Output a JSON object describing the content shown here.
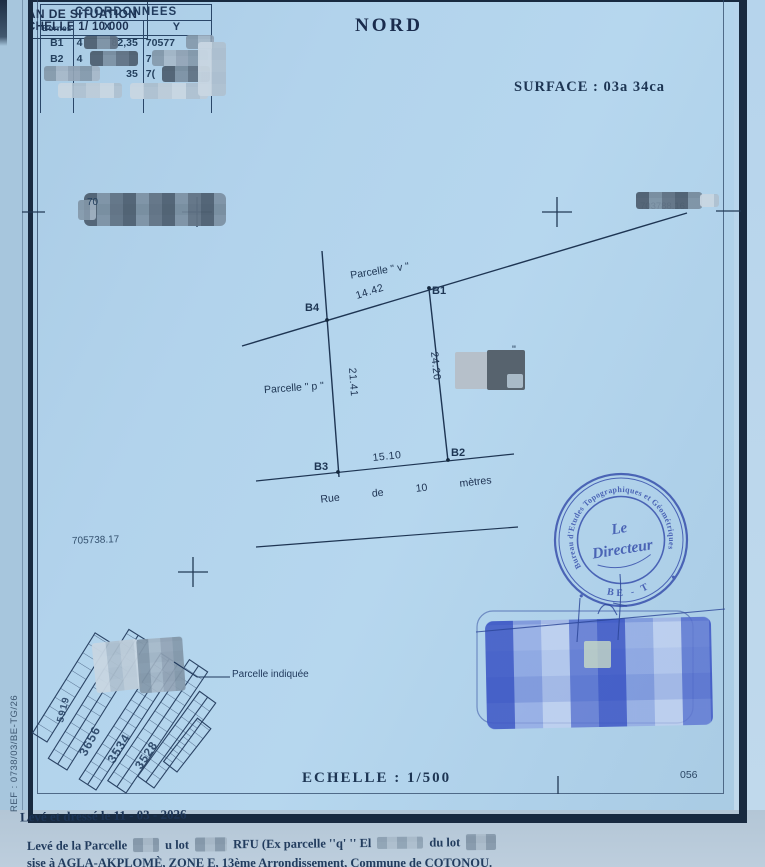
{
  "page": {
    "nord": "NORD",
    "surface": "SURFACE : 03a 34ca",
    "echelle": "ECHELLE : 1/500",
    "sheet_no": "056",
    "ref": "REF : 0738/03/BE-TG/26"
  },
  "coord_table": {
    "title": "COORDONNEES",
    "cols": {
      "bornes": "Bornes",
      "x": "X",
      "y": "Y"
    },
    "rows": [
      {
        "borne": "B1",
        "x_a": "4",
        "x_b": "82,35",
        "y_a": "70577"
      },
      {
        "borne": "B2",
        "x_a": "4",
        "x_b": "",
        "y_a": "7"
      },
      {
        "borne": "",
        "x_a": "",
        "x_b": "35",
        "y_a": "7("
      },
      {
        "borne": "",
        "x_a": "",
        "x_b": "",
        "y_a": ""
      }
    ]
  },
  "grid_refs": {
    "left": "705738.17",
    "right": "703788.16",
    "top_left": "70"
  },
  "parcel": {
    "label_v": "Parcelle \" v \"",
    "label_p": "Parcelle \" p \"",
    "b1": "B1",
    "b2": "B2",
    "b3": "B3",
    "b4": "B4",
    "dim_top": "14.42",
    "dim_right": "24.20",
    "dim_left": "21.41",
    "dim_bottom": "15.10",
    "street_w1": "Rue",
    "street_w2": "de",
    "street_w3": "10",
    "street_w4": "mètres",
    "stray_quote": "\""
  },
  "situation": {
    "title_line1": "PLAN DE SITUATION",
    "title_line2": "ECHELLE 1/ 10 000",
    "callout": "Parcelle indiquée",
    "blocks": [
      "5919",
      "3656",
      "3534",
      "3528"
    ]
  },
  "stamp": {
    "ring_text": "Bureau d'Etudes Topographiques et Géométriques",
    "center_line1": "Le",
    "center_line2": "Directeur",
    "bottom_text": "BE - T"
  },
  "footer": {
    "line1": "Levé et dressé  le 11 - 03 - 2026",
    "line2_a": "Levé de la Parcelle",
    "line2_b": "u lot",
    "line2_c": "RFU (Ex parcelle ''q' '' El",
    "line2_d": "du lot",
    "line3": "sise à AGLA-AKPLOMÈ, ZONE E, 13ème Arrondissement, Commune de COTONOU."
  },
  "colors": {
    "paper": "#afd0ea",
    "ink": "#1d3553",
    "stamp_blue": "#3d55ae",
    "signature_blue": "#3a54c0",
    "redaction_gray": "#8fa3b6"
  }
}
